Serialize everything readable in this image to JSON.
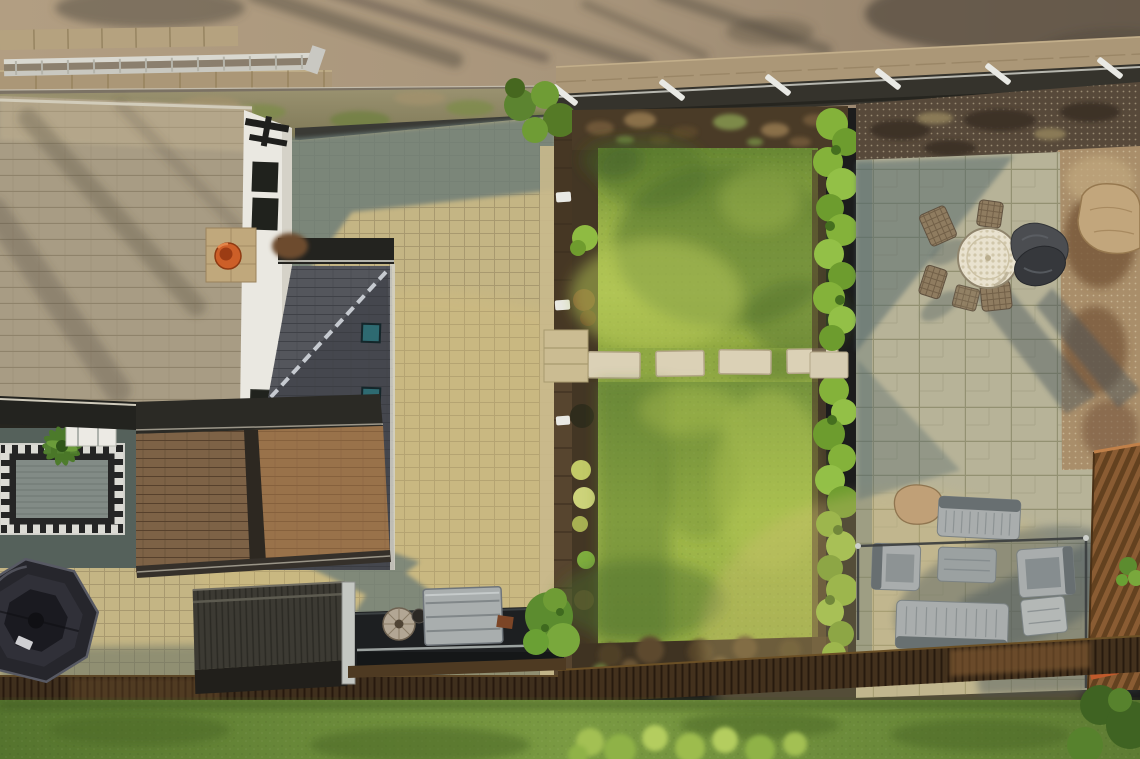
{
  "scene": {
    "aria": "Aerial drone photograph of a residential back garden: slate house roof with orange chimney pot, cobbled courtyard crossed by long house shadows, octagonal hot tub, storage shed and flatbed trailer, two bright lawns divided by a stepping-stone path, a clipped hedge, and an Indian-stone patio with a round mosaic bistro table and grey rattan lounge furniture, bounded by a road at the top and a timber fence with grass verge at the bottom.",
    "title": "Aerial garden view",
    "stepping_stones_count": 5,
    "boundary_posts_count": 6
  },
  "palette": {
    "road": "#a8957b",
    "road_shadow": "#574e42",
    "wall": "#ab9777",
    "ladder": "#d9d8d0",
    "fence_dark": "#35332c",
    "post_white": "#e9e9e4",
    "cobble_sun": "#c4b584",
    "cobble_shadow": "#6c7c77",
    "roof_tile": "#a89c84",
    "gable_white": "#eae8e1",
    "chimney_pot": "#cd5f28",
    "slate_roof": "#54565c",
    "skylight": "#2e6a71",
    "shingle": "#7d6246",
    "porch_floor": "#55615b",
    "hottub": "#26262c",
    "shed": "#3c3a33",
    "storage_box": "#a9aeae",
    "deck_board": "#3f2f1d",
    "lawn_sun": "#a7bf4f",
    "lawn_shadow": "#4c6b2b",
    "bed_soil": "#4a3b27",
    "hedge": "#84b23a",
    "stone_slab": "#dbd1b6",
    "patio_stone": "#b7b398",
    "patio_shadow": "#51666a",
    "gravel_dark": "#57493a",
    "leaf_litter": "#77563a",
    "rock": "#c2a67c",
    "table_top": "#e9e2cf",
    "wicker_brown": "#8f7c60",
    "lounge_dark": "#4b4d51",
    "rattan_gray": "#a9adad",
    "railing": "#3a3d3e",
    "fence_panel": "#8a5c33",
    "accent_orange": "#c05a2c",
    "grass_bottom": "#7a9a42"
  },
  "objects": [
    {
      "id": "road",
      "label": "Asphalt road with tree-branch shadows"
    },
    {
      "id": "ladder",
      "label": "Aluminium ladder lying on the boundary wall"
    },
    {
      "id": "boundary-fence",
      "label": "Dark boundary fence with white angled brackets"
    },
    {
      "id": "main-roof",
      "label": "Stone-slate house roof"
    },
    {
      "id": "chimney",
      "label": "Chimney stack with orange clay pot"
    },
    {
      "id": "gable",
      "label": "White rendered gable wall with windows"
    },
    {
      "id": "hip-roof",
      "label": "Dark slate hip roof with two rooflights"
    },
    {
      "id": "wing-roof",
      "label": "Brown shingled rear wing roof"
    },
    {
      "id": "porch",
      "label": "Veranda with patterned rug and potted palm"
    },
    {
      "id": "driveway",
      "label": "Cobbled courtyard crossed by house shadow"
    },
    {
      "id": "hot-tub",
      "label": "Octagonal hot tub with dark cover"
    },
    {
      "id": "shed",
      "label": "Metal storage shed"
    },
    {
      "id": "trailer",
      "label": "Flatbed trailer with storage box and millstone"
    },
    {
      "id": "upper-lawn",
      "label": "Upper lawn"
    },
    {
      "id": "lower-lawn",
      "label": "Lower lawn"
    },
    {
      "id": "stepping-stones",
      "label": "Stepping-stone path across the lawn"
    },
    {
      "id": "hedge",
      "label": "Clipped hedge between lawn and patio"
    },
    {
      "id": "patio",
      "label": "Indian-stone patio"
    },
    {
      "id": "bistro-set",
      "label": "Round mosaic table with wicker chairs"
    },
    {
      "id": "lounge-set",
      "label": "Grey rattan corner lounge set"
    },
    {
      "id": "garden-rock",
      "label": "Stone rockery ornament"
    },
    {
      "id": "side-fence",
      "label": "Timber slatted side fence"
    },
    {
      "id": "deck-fence",
      "label": "Rear timber fence line"
    },
    {
      "id": "verge-grass",
      "label": "Grass verge beyond the rear fence"
    }
  ]
}
